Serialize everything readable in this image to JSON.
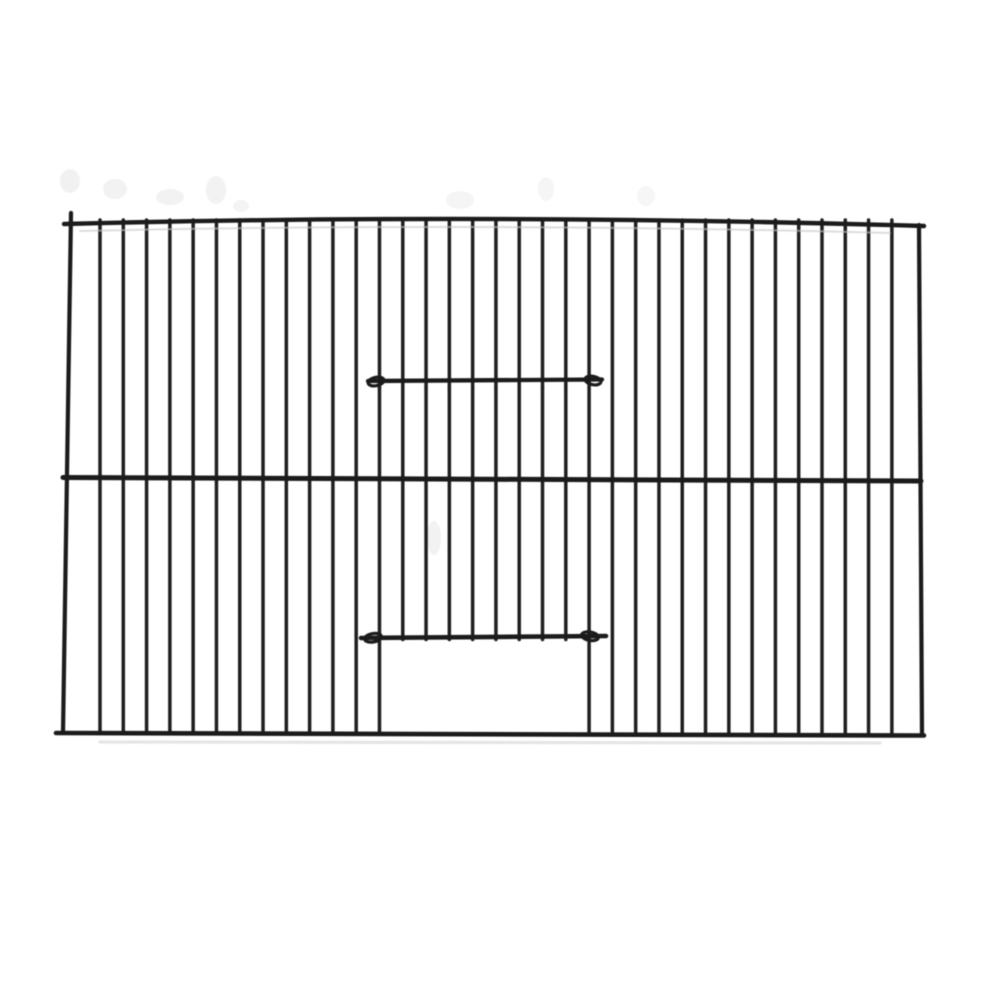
{
  "image": {
    "subject": "black wire cage front panel with vertical bars and a center sliding door over an open doorway",
    "background_color": "#ffffff"
  },
  "figure": {
    "canvas": {
      "width": 1000,
      "height": 1000
    },
    "colors": {
      "wire": "#1f1f1f",
      "rail": "#1b1b1b",
      "ghost_line": "#c7c7c7",
      "shadow": "#dcdcdc",
      "smudge": "#e6e6e6"
    },
    "frame": {
      "top_rail": {
        "x1": 64,
        "y1": 224,
        "cx": 480,
        "cy": 213,
        "x2": 924,
        "y2": 226,
        "width": 4.4
      },
      "ghost_line": {
        "x1": 80,
        "y1": 231,
        "cx": 480,
        "cy": 222,
        "x2": 890,
        "y2": 233,
        "width": 2,
        "opacity": 0.6
      },
      "middle_rail": {
        "x1": 63,
        "y1": 477.5,
        "x2": 921,
        "y2": 481,
        "width": 5
      },
      "bottom_rail": {
        "x1": 56,
        "y1": 733,
        "x2": 924,
        "y2": 735.5,
        "width": 4.6
      },
      "bottom_shadow": {
        "x1": 100,
        "y1": 742,
        "x2": 880,
        "y2": 743,
        "width": 3.2,
        "opacity": 0.75
      },
      "left_wire": {
        "x1": 71,
        "y1": 213,
        "x2": 63,
        "y2": 733,
        "width": 4.2
      },
      "right_wire": {
        "x1": 919,
        "y1": 225,
        "x2": 922,
        "y2": 734,
        "width": 4.2
      }
    },
    "bars": {
      "count": 35,
      "first_x": 100,
      "spacing": 23.29,
      "top_y": 220,
      "bottom_y": 733.5,
      "width": 3.5,
      "door_left_index": 12,
      "door_right_index": 21,
      "door_stop_y": 639.5
    },
    "door": {
      "top_wire": {
        "x1": 368,
        "y1": 381,
        "x2": 602,
        "y2": 379.5,
        "width": 4.3
      },
      "bottom_wire": {
        "x1": 361,
        "y1": 638,
        "x2": 606,
        "y2": 636,
        "width": 4.6
      },
      "opening": {
        "x1": 382,
        "y1": 641,
        "x2": 588,
        "y2": 731
      },
      "hooks": [
        {
          "cx": 376,
          "cy": 381.5,
          "rx": 8,
          "ry": 4.2,
          "rot": -12
        },
        {
          "cx": 593,
          "cy": 380.5,
          "rx": 8,
          "ry": 4.2,
          "rot": 12
        },
        {
          "cx": 373,
          "cy": 637.8,
          "rx": 8.5,
          "ry": 4.2,
          "rot": -10
        },
        {
          "cx": 590,
          "cy": 636.2,
          "rx": 8.5,
          "ry": 4.2,
          "rot": 10
        }
      ],
      "weld_dots": {
        "from_index": 12,
        "to_index": 21,
        "cy": 388,
        "rx": 1.7,
        "ry": 4.4,
        "opacity": 0.7
      }
    },
    "smudges": [
      {
        "cx": 70,
        "cy": 181,
        "rx": 10,
        "ry": 12,
        "opacity": 0.55
      },
      {
        "cx": 115,
        "cy": 189,
        "rx": 12,
        "ry": 10,
        "opacity": 0.5
      },
      {
        "cx": 170,
        "cy": 197,
        "rx": 14,
        "ry": 8,
        "opacity": 0.5
      },
      {
        "cx": 216,
        "cy": 190,
        "rx": 10,
        "ry": 14,
        "opacity": 0.5
      },
      {
        "cx": 241,
        "cy": 206,
        "rx": 8,
        "ry": 6,
        "opacity": 0.45
      },
      {
        "cx": 460,
        "cy": 200,
        "rx": 14,
        "ry": 9,
        "opacity": 0.4
      },
      {
        "cx": 546,
        "cy": 189,
        "rx": 8,
        "ry": 12,
        "opacity": 0.4
      },
      {
        "cx": 646,
        "cy": 196,
        "rx": 9,
        "ry": 10,
        "opacity": 0.35
      },
      {
        "cx": 434,
        "cy": 538,
        "rx": 7,
        "ry": 17,
        "opacity": 0.5
      }
    ]
  }
}
